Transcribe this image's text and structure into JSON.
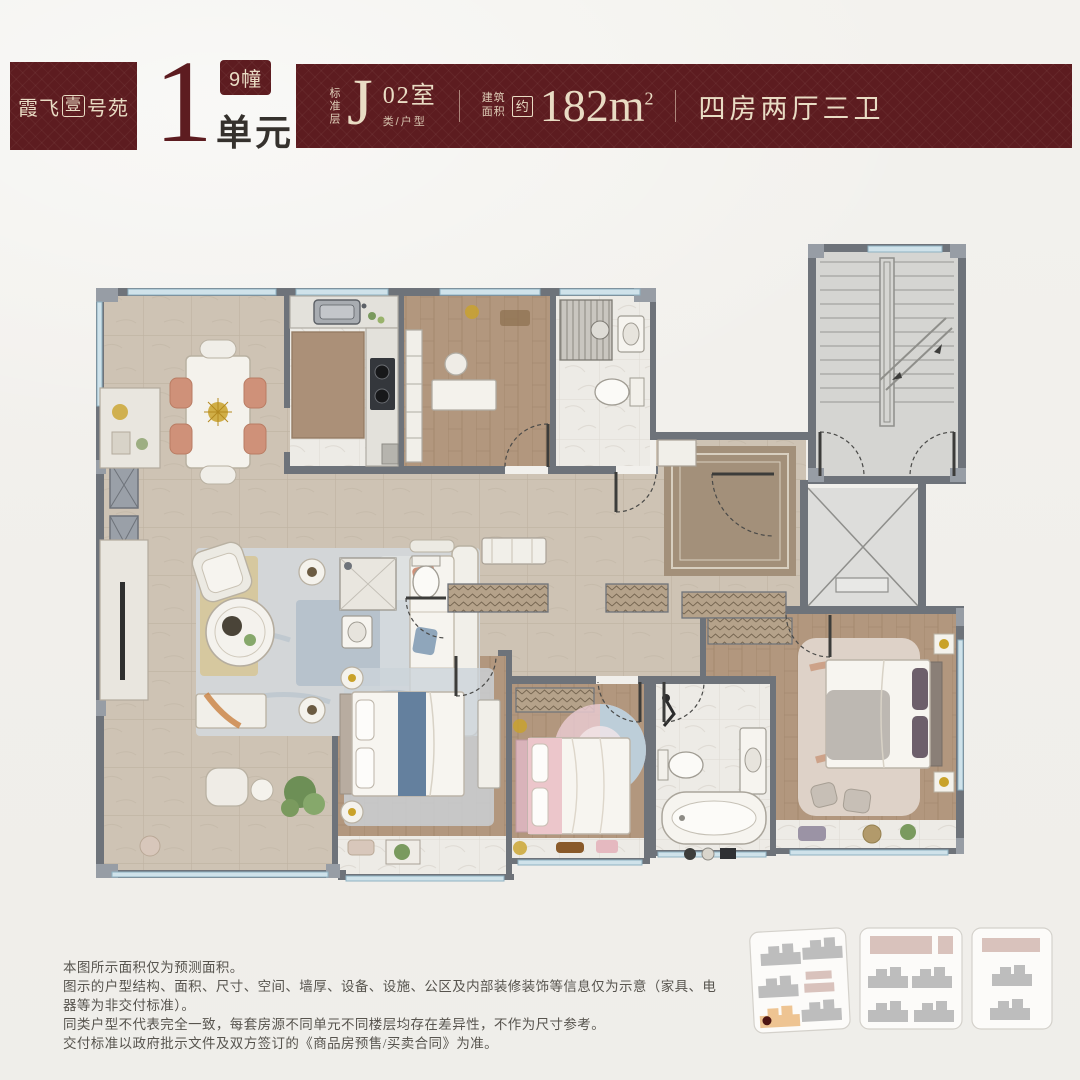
{
  "header": {
    "logo": {
      "part1": "霞飞",
      "boxed_char": "壹",
      "part2": "号苑"
    },
    "unit": {
      "number": "1",
      "building_badge": "9幢",
      "unit_label": "单元"
    },
    "banner": {
      "floor_label": "标准层",
      "type_letter": "J",
      "room": "02室",
      "room_caption": "类/户型",
      "area_label_line1": "建筑",
      "area_label_line2": "面积",
      "approx": "约",
      "area_value": "182m",
      "area_sup": "2",
      "layout": "四房两厅三卫"
    }
  },
  "disclaimer": {
    "lines": [
      "本图所示面积仅为预测面积。",
      "图示的户型结构、面积、尺寸、空间、墙厚、设备、设施、公区及内部装修装饰等信息仅为示意（家具、电器等为非交付标准）。",
      "同类户型不代表完全一致，每套房源不同单元不同楼层均存在差异性，不作为尺寸参考。",
      "交付标准以政府批示文件及双方签订的《商品房预售/买卖合同》为准。"
    ]
  },
  "colors": {
    "maroon": "#5d1c20",
    "cream": "#e9dcc4",
    "page_bg": "#f1efeb",
    "wall_gray": "#6e737a",
    "wall_light": "#979da5",
    "tile_floor": "#cec3b4",
    "wood_floor": "#b2977e",
    "white_floor": "#edebe6",
    "window_blue": "#bdd5de",
    "stair_floor": "#d5d5d2",
    "entry_mat": "#a3907a",
    "site_building_gray": "#bdbdbd",
    "site_building_pink": "#d9c2bc",
    "site_building_highlight": "#eec492",
    "site_location_dot": "#4d1512"
  }
}
